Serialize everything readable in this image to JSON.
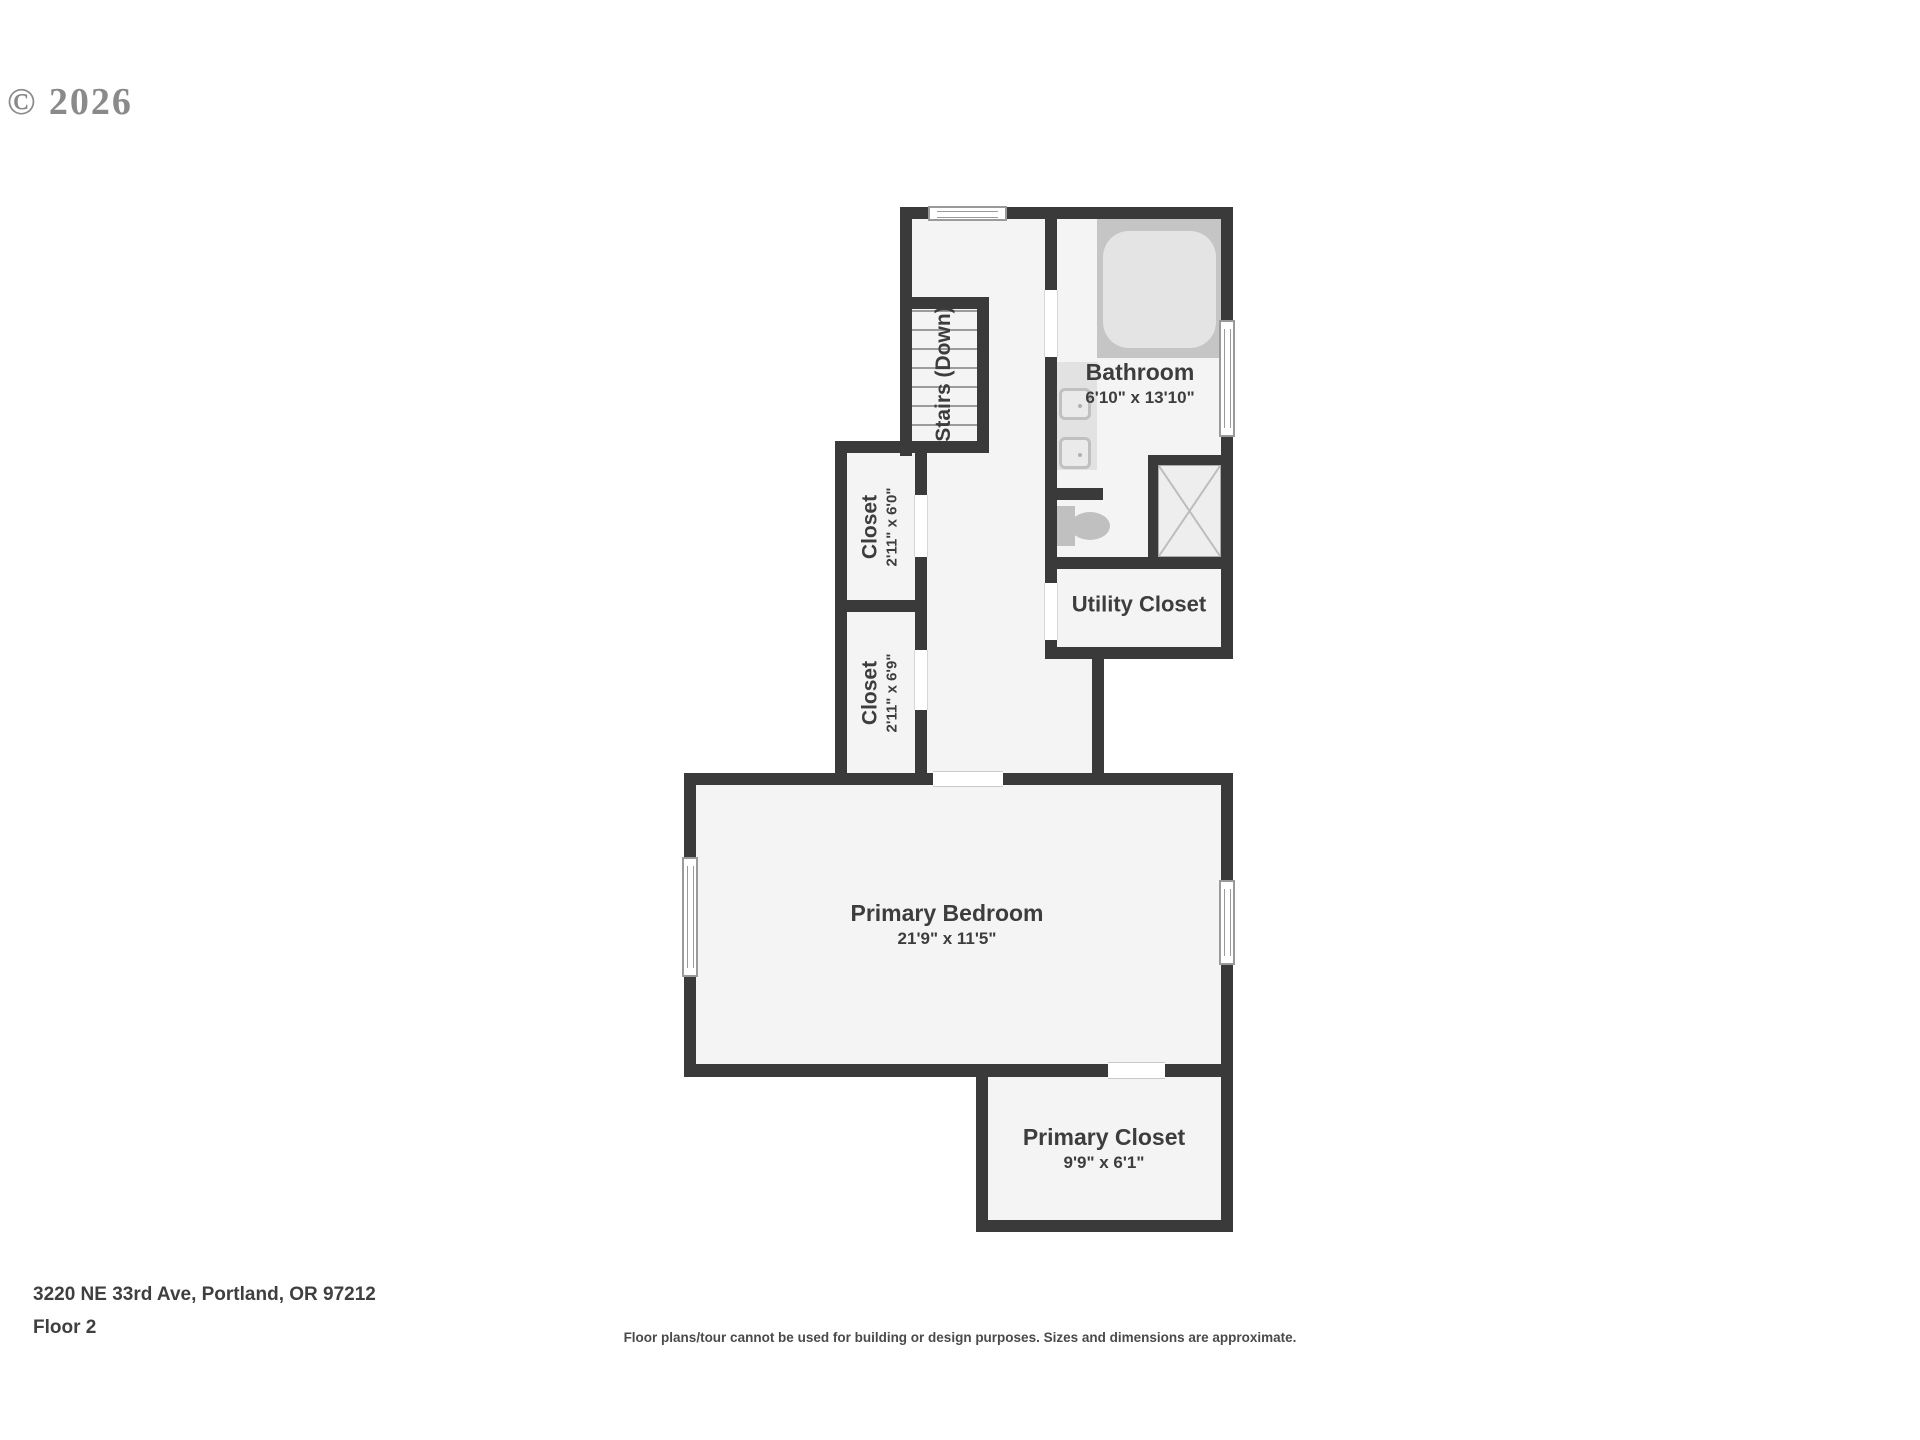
{
  "watermark": {
    "copyright": "© 2026"
  },
  "plan": {
    "rooms": [
      {
        "id": "bathroom",
        "name": "Bathroom",
        "dims": "6'10\" x 13'10\""
      },
      {
        "id": "utility-closet",
        "name": "Utility Closet",
        "dims": ""
      },
      {
        "id": "closet-upper",
        "name": "Closet",
        "dims": "2'11\" x 6'0\""
      },
      {
        "id": "closet-lower",
        "name": "Closet",
        "dims": "2'11\" x 6'9\""
      },
      {
        "id": "primary-bedroom",
        "name": "Primary Bedroom",
        "dims": "21'9\" x 11'5\""
      },
      {
        "id": "primary-closet",
        "name": "Primary Closet",
        "dims": "9'9\" x 6'1\""
      },
      {
        "id": "stairs",
        "name": "Stairs (Down)",
        "dims": ""
      }
    ],
    "fixtures": [
      "bathtub",
      "vanity-sink",
      "vanity-sink",
      "toilet",
      "shower"
    ],
    "colors": {
      "wall": "#3a3a3a",
      "floor": "#f4f4f4",
      "fixture": "#c3c3c3",
      "fixture_light": "#e4e4e4",
      "label_text": "#3d3d3d"
    }
  },
  "footer": {
    "address": "3220 NE 33rd Ave, Portland, OR 97212",
    "floor": "Floor 2",
    "disclaimer": "Floor plans/tour cannot be used for building or design purposes. Sizes and dimensions are approximate."
  }
}
